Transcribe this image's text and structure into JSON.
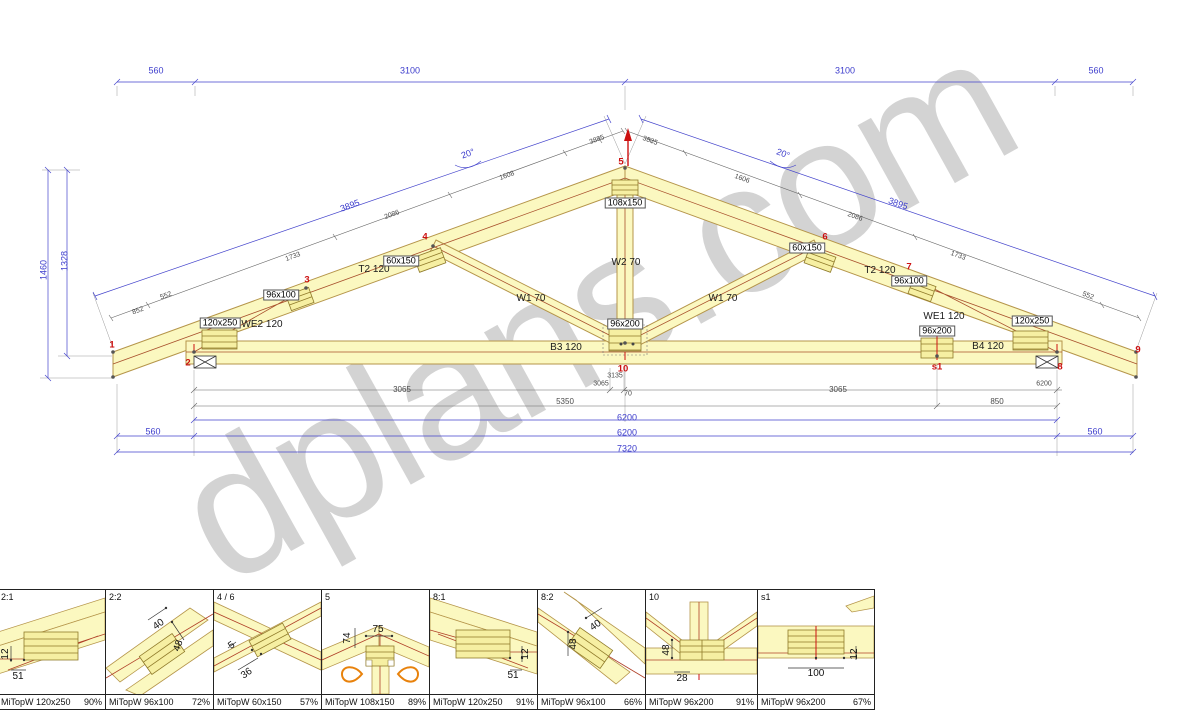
{
  "watermark": {
    "text": "dplans.com"
  },
  "drawing": {
    "labels": [
      {
        "t": "560",
        "x": 156,
        "y": 71,
        "c": "b"
      },
      {
        "t": "3100",
        "x": 410,
        "y": 71,
        "c": "b"
      },
      {
        "t": "3100",
        "x": 845,
        "y": 71,
        "c": "b"
      },
      {
        "t": "560",
        "x": 1096,
        "y": 71,
        "c": "b"
      },
      {
        "t": "1460",
        "x": 44,
        "y": 270,
        "r": -90,
        "c": "b"
      },
      {
        "t": "1328",
        "x": 65,
        "y": 261,
        "r": -90,
        "c": "b"
      },
      {
        "t": "20°",
        "x": 468,
        "y": 154,
        "r": -20,
        "c": "b"
      },
      {
        "t": "3895",
        "x": 350,
        "y": 206,
        "r": -20,
        "c": "b"
      },
      {
        "t": "20°",
        "x": 783,
        "y": 154,
        "r": 20,
        "c": "b"
      },
      {
        "t": "3895",
        "x": 898,
        "y": 204,
        "r": 20,
        "c": "b"
      },
      {
        "t": "852",
        "x": 138,
        "y": 311,
        "r": -20,
        "c": "g s"
      },
      {
        "t": "552",
        "x": 166,
        "y": 296,
        "r": -20,
        "c": "g s"
      },
      {
        "t": "1733",
        "x": 293,
        "y": 257,
        "r": -20,
        "c": "g s"
      },
      {
        "t": "2086",
        "x": 392,
        "y": 215,
        "r": -20,
        "c": "g s"
      },
      {
        "t": "1608",
        "x": 507,
        "y": 176,
        "r": -20,
        "c": "g s"
      },
      {
        "t": "3885",
        "x": 597,
        "y": 140,
        "r": -20,
        "c": "g s"
      },
      {
        "t": "3835",
        "x": 650,
        "y": 141,
        "r": 20,
        "c": "g s"
      },
      {
        "t": "1606",
        "x": 742,
        "y": 179,
        "r": 20,
        "c": "g s"
      },
      {
        "t": "2086",
        "x": 855,
        "y": 217,
        "r": 20,
        "c": "g s"
      },
      {
        "t": "1733",
        "x": 958,
        "y": 256,
        "r": 20,
        "c": "g s"
      },
      {
        "t": "552",
        "x": 1088,
        "y": 296,
        "r": 20,
        "c": "g s"
      },
      {
        "t": "3065",
        "x": 402,
        "y": 390,
        "c": "g"
      },
      {
        "t": "3135",
        "x": 615,
        "y": 376,
        "c": "g s"
      },
      {
        "t": "3065",
        "x": 601,
        "y": 384,
        "c": "g s"
      },
      {
        "t": "70",
        "x": 628,
        "y": 394,
        "c": "g s"
      },
      {
        "t": "3065",
        "x": 838,
        "y": 390,
        "c": "g"
      },
      {
        "t": "6200",
        "x": 1044,
        "y": 384,
        "c": "g s"
      },
      {
        "t": "5350",
        "x": 565,
        "y": 402,
        "c": "g"
      },
      {
        "t": "850",
        "x": 997,
        "y": 402,
        "c": "g"
      },
      {
        "t": "6200",
        "x": 627,
        "y": 418,
        "c": "b"
      },
      {
        "t": "560",
        "x": 153,
        "y": 432,
        "c": "b"
      },
      {
        "t": "6200",
        "x": 627,
        "y": 433,
        "c": "b"
      },
      {
        "t": "560",
        "x": 1095,
        "y": 432,
        "c": "b"
      },
      {
        "t": "7320",
        "x": 627,
        "y": 449,
        "c": "b"
      },
      {
        "t": "T2 120",
        "x": 374,
        "y": 270,
        "c": "m"
      },
      {
        "t": "T2 120",
        "x": 880,
        "y": 271,
        "c": "m"
      },
      {
        "t": "W2 70",
        "x": 626,
        "y": 263,
        "c": "m"
      },
      {
        "t": "W1 70",
        "x": 531,
        "y": 299,
        "c": "m"
      },
      {
        "t": "W1 70",
        "x": 723,
        "y": 299,
        "c": "m"
      },
      {
        "t": "B3 120",
        "x": 566,
        "y": 348,
        "c": "m"
      },
      {
        "t": "B4 120",
        "x": 988,
        "y": 347,
        "c": "m"
      },
      {
        "t": "WE2 120",
        "x": 262,
        "y": 325,
        "c": "m"
      },
      {
        "t": "WE1 120",
        "x": 944,
        "y": 317,
        "c": "m"
      },
      {
        "t": "120x250",
        "x": 220,
        "y": 323,
        "c": "p"
      },
      {
        "t": "96x100",
        "x": 281,
        "y": 295,
        "c": "p"
      },
      {
        "t": "60x150",
        "x": 401,
        "y": 261,
        "c": "p"
      },
      {
        "t": "108x150",
        "x": 625,
        "y": 203,
        "c": "p"
      },
      {
        "t": "96x200",
        "x": 625,
        "y": 324,
        "c": "p"
      },
      {
        "t": "60x150",
        "x": 807,
        "y": 248,
        "c": "p"
      },
      {
        "t": "96x100",
        "x": 909,
        "y": 281,
        "c": "p"
      },
      {
        "t": "96x200",
        "x": 937,
        "y": 331,
        "c": "p"
      },
      {
        "t": "120x250",
        "x": 1032,
        "y": 321,
        "c": "p"
      },
      {
        "t": "1",
        "x": 112,
        "y": 345,
        "c": "r"
      },
      {
        "t": "2",
        "x": 188,
        "y": 363,
        "c": "r"
      },
      {
        "t": "3",
        "x": 307,
        "y": 280,
        "c": "r"
      },
      {
        "t": "4",
        "x": 425,
        "y": 237,
        "c": "r"
      },
      {
        "t": "5",
        "x": 621,
        "y": 162,
        "c": "r"
      },
      {
        "t": "6",
        "x": 825,
        "y": 237,
        "c": "r"
      },
      {
        "t": "7",
        "x": 909,
        "y": 267,
        "c": "r"
      },
      {
        "t": "8",
        "x": 1060,
        "y": 367,
        "c": "r"
      },
      {
        "t": "9",
        "x": 1138,
        "y": 350,
        "c": "r"
      },
      {
        "t": "10",
        "x": 623,
        "y": 369,
        "c": "r"
      },
      {
        "t": "s1",
        "x": 937,
        "y": 367,
        "c": "r"
      }
    ]
  },
  "panels": {
    "items": [
      {
        "title": "2:1",
        "plate": "MiTopW 120x250",
        "pct": "90%",
        "dims": [
          {
            "t": "12",
            "x": 8,
            "y": 64,
            "r": -90
          },
          {
            "t": "51",
            "x": 20,
            "y": 87
          }
        ]
      },
      {
        "title": "2:2",
        "plate": "MiTopW 96x100",
        "pct": "72%",
        "dims": [
          {
            "t": "40",
            "x": 53,
            "y": 35,
            "r": -35
          },
          {
            "t": "48",
            "x": 73,
            "y": 56,
            "r": -70
          }
        ]
      },
      {
        "title": "4 / 6",
        "plate": "MiTopW 60x150",
        "pct": "57%",
        "dims": [
          {
            "t": "5",
            "x": 18,
            "y": 56,
            "r": -35
          },
          {
            "t": "36",
            "x": 33,
            "y": 84,
            "r": -35
          }
        ]
      },
      {
        "title": "5",
        "plate": "MiTopW 108x150",
        "pct": "89%",
        "dims": [
          {
            "t": "74",
            "x": 26,
            "y": 48,
            "r": -90
          },
          {
            "t": "75",
            "x": 56,
            "y": 40
          }
        ]
      },
      {
        "title": "8:1",
        "plate": "MiTopW 120x250",
        "pct": "91%",
        "dims": [
          {
            "t": "12",
            "x": 96,
            "y": 64,
            "r": -90
          },
          {
            "t": "51",
            "x": 83,
            "y": 86
          }
        ]
      },
      {
        "title": "8:2",
        "plate": "MiTopW 96x100",
        "pct": "66%",
        "dims": [
          {
            "t": "48",
            "x": 36,
            "y": 54,
            "r": -90
          },
          {
            "t": "40",
            "x": 58,
            "y": 36,
            "r": -35
          }
        ]
      },
      {
        "title": "10",
        "plate": "MiTopW 96x200",
        "pct": "91%",
        "dims": [
          {
            "t": "48",
            "x": 21,
            "y": 60,
            "r": -90
          },
          {
            "t": "28",
            "x": 36,
            "y": 89
          }
        ]
      },
      {
        "title": "s1",
        "plate": "MiTopW 96x200",
        "pct": "67%",
        "dims": [
          {
            "t": "100",
            "x": 58,
            "y": 84
          },
          {
            "t": "12",
            "x": 97,
            "y": 64,
            "r": -90
          }
        ]
      }
    ]
  }
}
